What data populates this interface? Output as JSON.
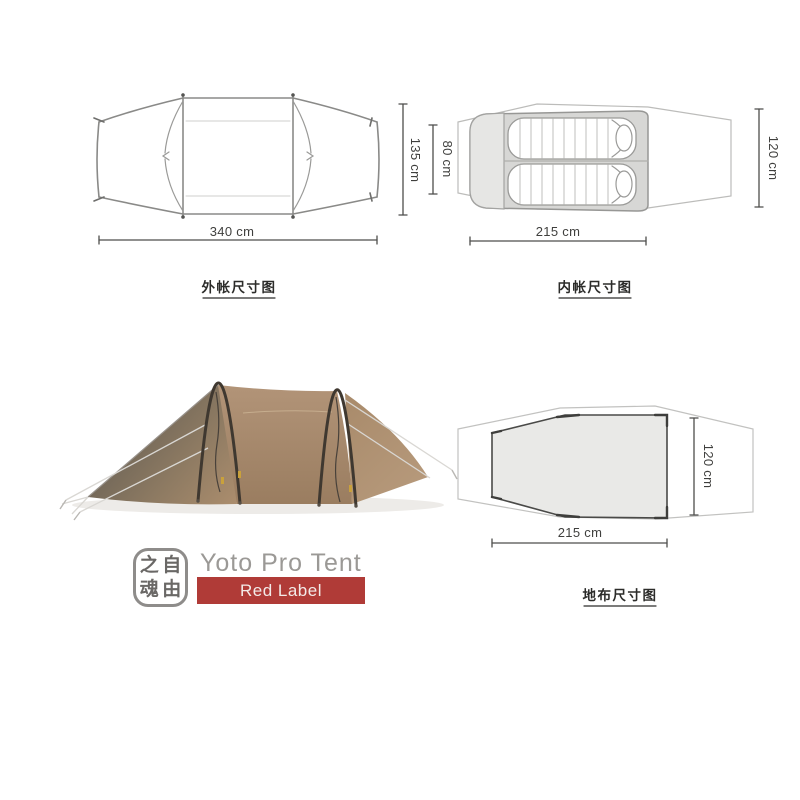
{
  "brand": {
    "product_name": "Yoto Pro Tent",
    "edition": "Red Label",
    "logo_characters": {
      "top_left": "之",
      "top_right": "自",
      "bottom_left": "魂",
      "bottom_right": "由"
    }
  },
  "diagrams": {
    "fly": {
      "caption": "外帐尺寸图",
      "length_label": "340 cm",
      "width_label": "135 cm",
      "length_cm": 340,
      "width_cm": 135
    },
    "inner": {
      "caption": "内帐尺寸图",
      "door_label": "80 cm",
      "length_label": "215 cm",
      "width_label": "120 cm",
      "door_cm": 80,
      "length_cm": 215,
      "width_cm": 120
    },
    "footprint": {
      "caption": "地布尺寸图",
      "length_label": "215 cm",
      "width_label": "120 cm",
      "length_cm": 215,
      "width_cm": 120
    }
  },
  "colors": {
    "accent_red": "#b03b37",
    "tent_fabric": "#ab8d6d",
    "tent_shadow_face": "#6e675c",
    "diagram_line": "#8a8a88",
    "light_outline": "#bcbcba",
    "fill_gray": "#e9e9e7"
  }
}
